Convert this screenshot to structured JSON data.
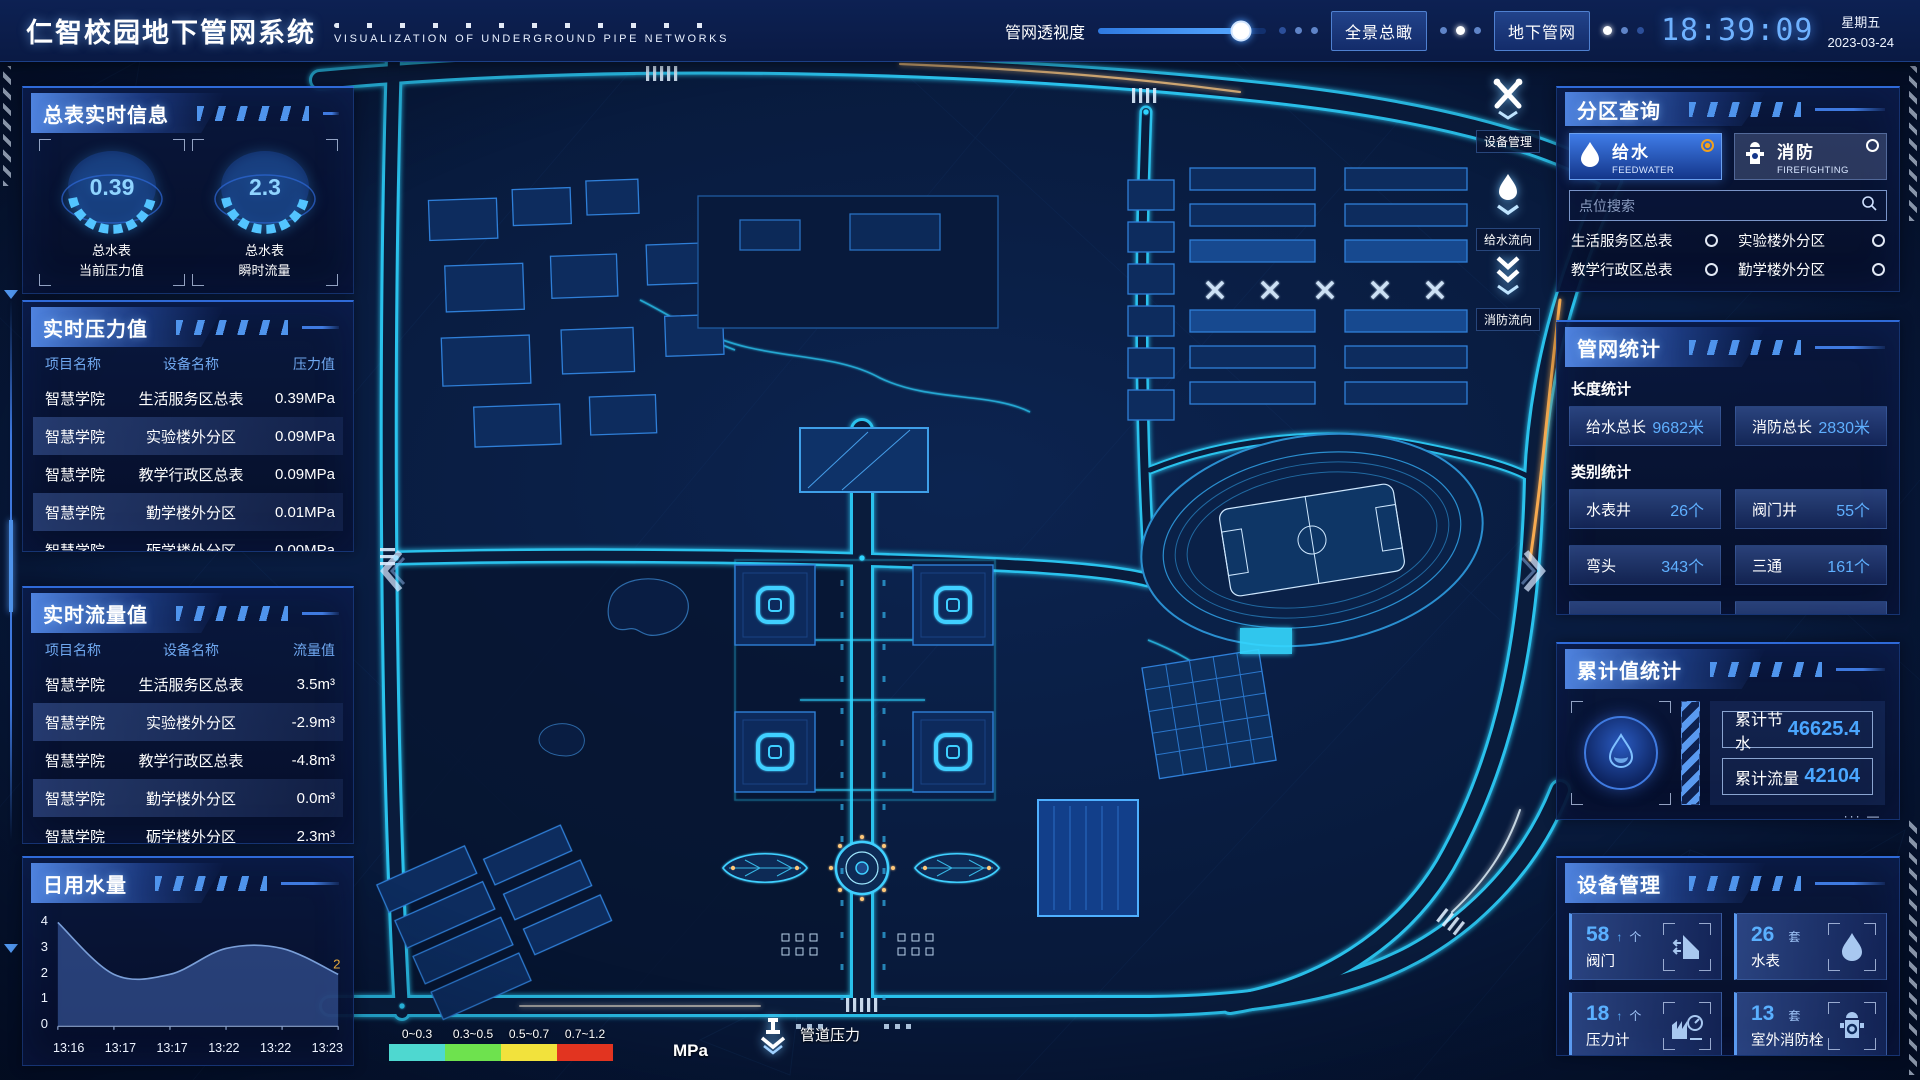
{
  "header": {
    "title": "仁智校园地下管网系统",
    "subtitle": "VISUALIZATION OF UNDERGROUND PIPE NETWORKS",
    "slider": {
      "label": "管网透视度",
      "value": 85
    },
    "buttons": [
      {
        "label": "全景总瞰"
      },
      {
        "label": "地下管网"
      }
    ],
    "clock": {
      "time": "18:39:09",
      "weekday": "星期五",
      "date": "2023-03-24"
    }
  },
  "left": {
    "meter_info": {
      "title": "总表实时信息",
      "gauges": [
        {
          "value": "0.39",
          "line1": "总水表",
          "line2": "当前压力值"
        },
        {
          "value": "2.3",
          "line1": "总水表",
          "line2": "瞬时流量"
        }
      ]
    },
    "pressure": {
      "title": "实时压力值",
      "headers": [
        "项目名称",
        "设备名称",
        "压力值"
      ],
      "rows": [
        [
          "智慧学院",
          "生活服务区总表",
          "0.39MPa"
        ],
        [
          "智慧学院",
          "实验楼外分区",
          "0.09MPa"
        ],
        [
          "智慧学院",
          "教学行政区总表",
          "0.09MPa"
        ],
        [
          "智慧学院",
          "勤学楼外分区",
          "0.01MPa"
        ],
        [
          "智慧学院",
          "砺学楼外分区",
          "0.00MPa"
        ]
      ]
    },
    "flow": {
      "title": "实时流量值",
      "headers": [
        "项目名称",
        "设备名称",
        "流量值"
      ],
      "rows": [
        [
          "智慧学院",
          "生活服务区总表",
          "3.5m³"
        ],
        [
          "智慧学院",
          "实验楼外分区",
          "-2.9m³"
        ],
        [
          "智慧学院",
          "教学行政区总表",
          "-4.8m³"
        ],
        [
          "智慧学院",
          "勤学楼外分区",
          "0.0m³"
        ],
        [
          "智慧学院",
          "砺学楼外分区",
          "2.3m³"
        ]
      ]
    },
    "daily_water": {
      "title": "日用水量"
    }
  },
  "chart_data": {
    "type": "area",
    "title": "日用水量",
    "x": [
      "13:16",
      "13:17",
      "13:17",
      "13:22",
      "13:22",
      "13:23"
    ],
    "values": [
      4,
      2,
      2,
      3,
      3,
      2
    ],
    "yticks": [
      0,
      1,
      2,
      3,
      4
    ],
    "ylim": [
      0,
      4
    ],
    "last_point_label": "2",
    "line_color": "#7a9fd8",
    "fill_color": "rgba(72,110,190,0.5)",
    "label_color": "#e8aa3c"
  },
  "right": {
    "zone_query": {
      "title": "分区查询",
      "tabs": [
        {
          "label": "给水",
          "sub": "FEEDWATER",
          "selected": true
        },
        {
          "label": "消防",
          "sub": "FIREFIGHTING",
          "selected": false
        }
      ],
      "search_placeholder": "点位搜索",
      "items": [
        "生活服务区总表",
        "实验楼外分区",
        "教学行政区总表",
        "勤学楼外分区",
        "砺学楼外分区",
        "宿舍区泵房"
      ]
    },
    "pipe_stats": {
      "title": "管网统计",
      "groups": [
        {
          "label": "长度统计",
          "stats": [
            {
              "name": "给水总长",
              "value": "9682米"
            },
            {
              "name": "消防总长",
              "value": "2830米"
            }
          ]
        },
        {
          "label": "类别统计",
          "stats": [
            {
              "name": "水表井",
              "value": "26个"
            },
            {
              "name": "阀门井",
              "value": "55个"
            },
            {
              "name": "弯头",
              "value": "343个"
            },
            {
              "name": "三通",
              "value": "161个"
            }
          ]
        }
      ]
    },
    "cumulative": {
      "title": "累计值统计",
      "stats": [
        {
          "label": "累计节水",
          "value": "46625.4"
        },
        {
          "label": "累计流量",
          "value": "42104"
        }
      ]
    },
    "devices": {
      "title": "设备管理",
      "cards": [
        {
          "count": "58",
          "arrow": "↑",
          "unit": "个",
          "label": "阀门"
        },
        {
          "count": "26",
          "arrow": "",
          "unit": "套",
          "label": "水表"
        },
        {
          "count": "18",
          "arrow": "↑",
          "unit": "个",
          "label": "压力计"
        },
        {
          "count": "13",
          "arrow": "",
          "unit": "套",
          "label": "室外消防栓"
        }
      ]
    }
  },
  "map": {
    "tools": [
      {
        "label": "设备管理"
      },
      {
        "label": "给水流向"
      },
      {
        "label": "消防流向"
      }
    ],
    "legend": {
      "ranges": [
        "0~0.3",
        "0.3~0.5",
        "0.5~0.7",
        "0.7~1.2"
      ],
      "colors": [
        "#4ed8d0",
        "#6ee24e",
        "#f2e23c",
        "#e23420"
      ],
      "unit": "MPa",
      "label": "管道压力"
    }
  }
}
